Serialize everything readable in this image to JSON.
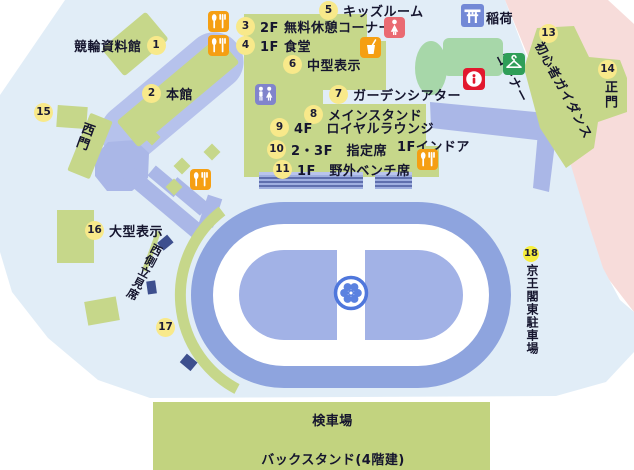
{
  "map": {
    "markers": [
      {
        "num": "1",
        "label": "競輪資料館"
      },
      {
        "num": "2",
        "label": "本館"
      },
      {
        "num": "3",
        "label": "2F 無料休憩コーナー"
      },
      {
        "num": "4",
        "label": "1F 食堂"
      },
      {
        "num": "5",
        "label": "キッズルーム"
      },
      {
        "num": "6",
        "label": "中型表示"
      },
      {
        "num": "7",
        "label": "ガーデンシアター"
      },
      {
        "num": "8",
        "label": "メインスタンド"
      },
      {
        "num": "9",
        "label": "4F　ロイヤルラウンジ"
      },
      {
        "num": "10",
        "label": "2・3F　指定席"
      },
      {
        "num": "11",
        "label": "1F　野外ベンチ席"
      },
      {
        "num": "13",
        "label": "初心者ガイダンスコーナー",
        "lines": [
          "初心者ガイダンス",
          "コーナー"
        ]
      },
      {
        "num": "14",
        "label": "正門"
      },
      {
        "num": "15",
        "label": "西門"
      },
      {
        "num": "16",
        "label": "大型表示"
      },
      {
        "num": "17",
        "label": "西側立見席"
      },
      {
        "num": "18",
        "label": "京王閣東駐車場"
      }
    ],
    "labels": {
      "inari": "稲荷",
      "indoor_1f": "1Fインドア",
      "inspection": "検車場",
      "backstand": "バックスタンド(4階建)"
    },
    "icons": {
      "restaurant": "fork-and-spoon",
      "drink": "cup-with-straw",
      "restroom": "man-and-woman",
      "female": "woman",
      "torii": "shrine-torii",
      "info": "information",
      "hanger": "cloakroom-hanger",
      "emblem": "flower-wheel"
    },
    "colors": {
      "map_bg": "#e1edf7",
      "outside_pink": "#f7dcda",
      "building_green": "#c6d78a",
      "mint_green": "#a7d7a9",
      "path_lavender": "#aab7e7",
      "track_blue": "#8ea4de",
      "infield_blue": "#a2b2e6",
      "marker_yellow": "#f8e98a",
      "marker_bright_yellow": "#f6ee3c",
      "icon_orange": "#f59f13",
      "icon_purple": "#8184cc",
      "icon_red": "#ea6a72",
      "info_red": "#e2182e",
      "torii_blue": "#7389d6",
      "hanger_green": "#2f9e58"
    }
  }
}
